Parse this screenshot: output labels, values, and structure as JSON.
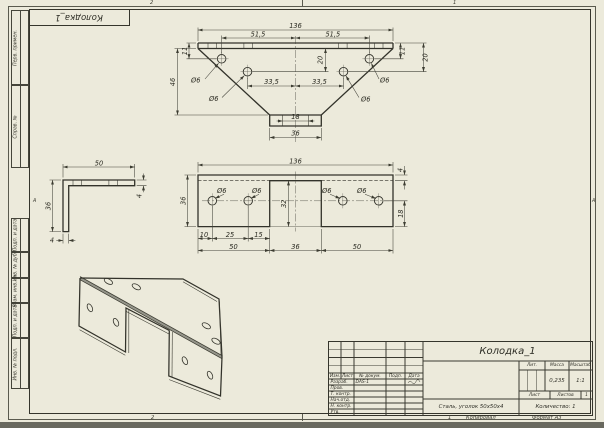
{
  "corner_stamp": {
    "title": "Колодка_1"
  },
  "margins": {
    "left_boxes": [
      "Перв. примен.",
      "Справ. №",
      "Подп. и дата",
      "Инв. № дубл.",
      "Взам. инв. №",
      "Подп. и дата",
      "Инв. № подл."
    ],
    "zone_top_l": "2",
    "zone_top_r": "1",
    "zone_bottom_l": "2",
    "zone_bottom_r": "1",
    "zone_letter": "А"
  },
  "top_view": {
    "w136": "136",
    "l515": "51,5",
    "r515": "51,5",
    "e11l": "11",
    "e11r": "11",
    "h20l": "20",
    "h20r": "20",
    "d46": "46",
    "c335l": "33,5",
    "c335r": "33,5",
    "t18": "18",
    "t36": "36",
    "o6a": "Ø6",
    "o6b": "Ø6",
    "o6c": "Ø6",
    "o6d": "Ø6"
  },
  "side_view": {
    "l50": "50",
    "t4": "4",
    "h36": "36",
    "b4": "4"
  },
  "front_view": {
    "w136": "136",
    "t4": "4",
    "h36": "36",
    "n32": "32",
    "e18": "18",
    "d10": "10",
    "d25": "25",
    "d15": "15",
    "s50a": "50",
    "s36": "36",
    "s50b": "50",
    "o6a": "Ø6",
    "o6b": "Ø6",
    "o6c": "Ø6",
    "o6d": "Ø6"
  },
  "title_block": {
    "name": "Колодка_1",
    "cols": [
      "Изм.",
      "Лист",
      "№ докум.",
      "Подп.",
      "Дата"
    ],
    "row_labels": [
      "Разраб.",
      "Пров.",
      "Т. контр.",
      "Нач.отд.",
      "Н. контр.",
      "Утв."
    ],
    "designer": "DAS-1",
    "lit": "Лит.",
    "mass": "Масса",
    "scale": "Масштаб",
    "mass_value": "0,235",
    "scale_value": "1:1",
    "sheet": "Лист",
    "sheets": "Листов",
    "sheets_value": "1",
    "material": "Сталь, уголок 50х50х4",
    "quantity": "Количество: 1",
    "copied": "Копировал",
    "format": "Формат А3"
  }
}
